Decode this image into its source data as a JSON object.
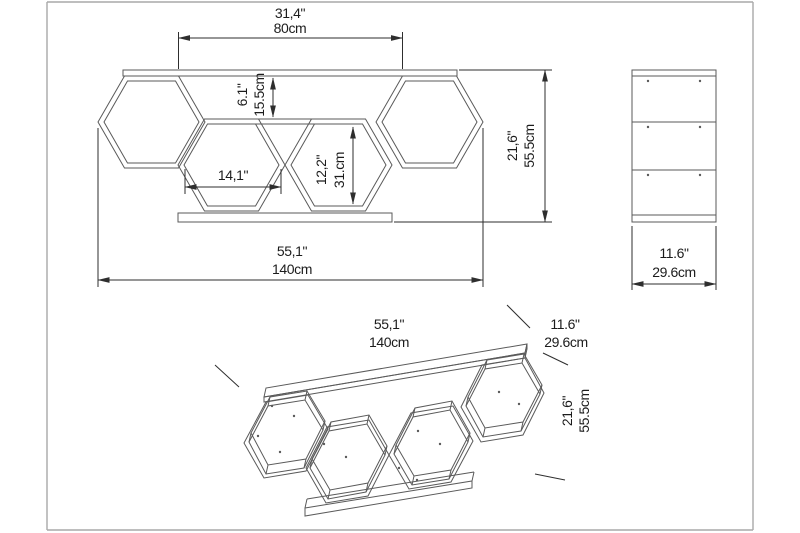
{
  "document": {
    "type": "furniture-dimension-drawing",
    "product": "hexagon honeycomb wall shelf"
  },
  "front_view": {
    "top_width_in": "31,4\"",
    "top_width_cm": "80cm",
    "top_offset_in": "6.1\"",
    "top_offset_cm": "15.5cm",
    "cell_width_in": "14,1\"",
    "cell_height_in": "12,2\"",
    "cell_height_cm": "31.cm",
    "height_in": "21,6\"",
    "height_cm": "55.5cm",
    "total_width_in": "55,1\"",
    "total_width_cm": "140cm"
  },
  "side_view": {
    "depth_in": "11.6\"",
    "depth_cm": "29.6cm"
  },
  "perspective_view": {
    "width_in": "55,1\"",
    "width_cm": "140cm",
    "depth_in": "11.6\"",
    "depth_cm": "29.6cm",
    "height_in": "21,6\"",
    "height_cm": "55.5cm"
  },
  "colors": {
    "background": "#ffffff",
    "geometry_line": "#5a5a5a",
    "dimension_line": "#2e2e2e",
    "text": "#1c1c1c",
    "frame": "#a9a9a9"
  }
}
